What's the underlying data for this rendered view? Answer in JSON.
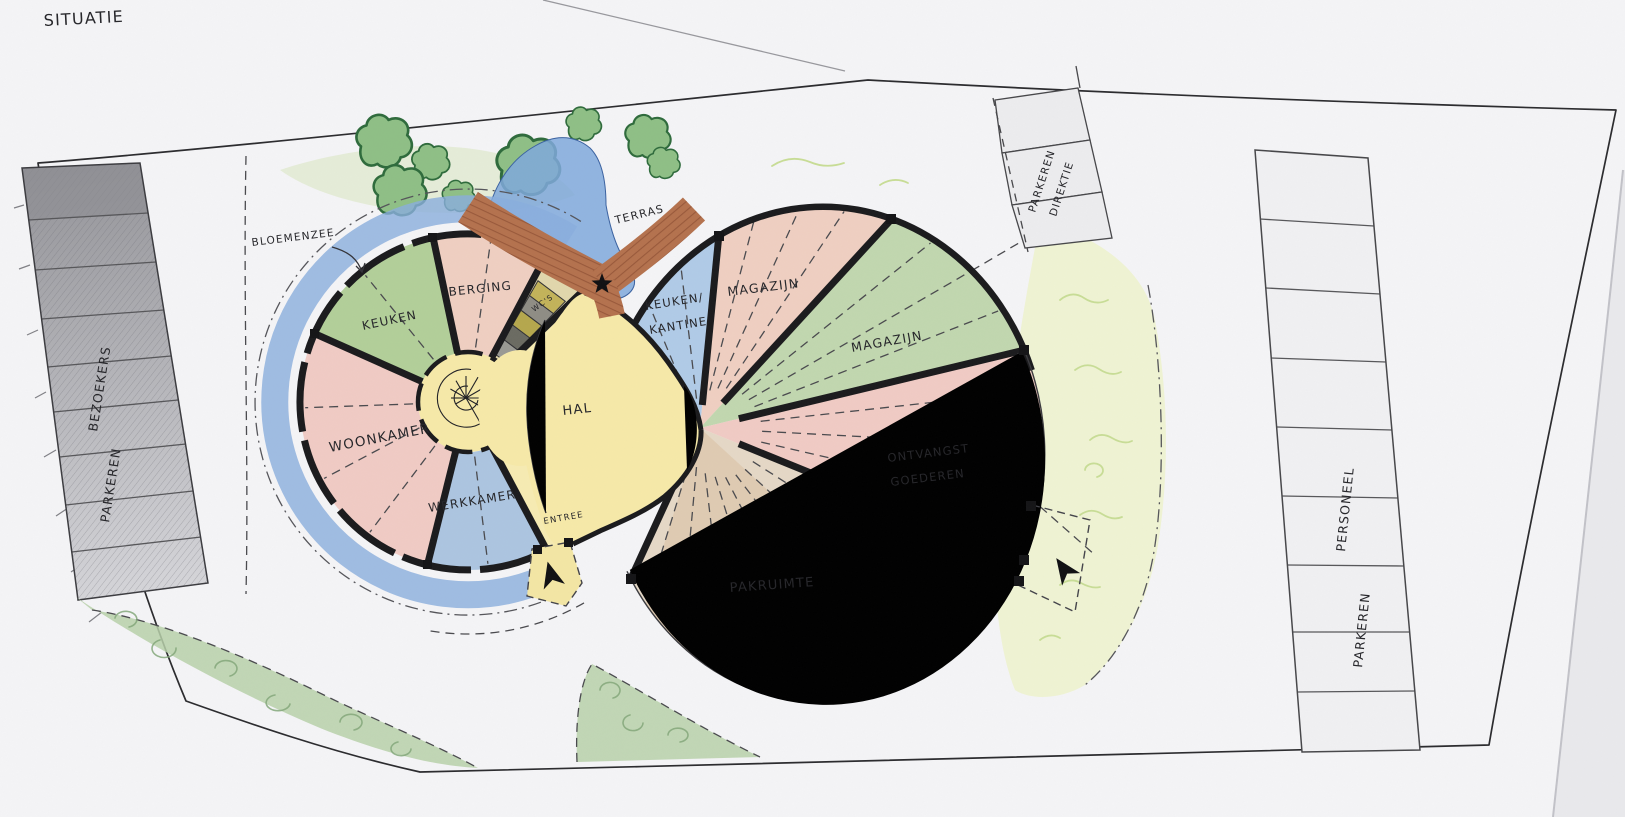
{
  "title": "SITUATIE",
  "colors": {
    "paper": "#f4f4f6",
    "wall": "#1b1b1d",
    "pink_room": "#efc5bd",
    "salmon_room": "#eec9ba",
    "green_room": "#a9c98c",
    "green_room_right": "#b9d3a5",
    "blue_room": "#a2bedd",
    "blue_room_right": "#a6c5e5",
    "yellow_hall": "#f6e9a8",
    "tan_pakruimte": "#e3d4bf",
    "brown_terrace": "#b4724e",
    "pond_blue": "#7fa8dc",
    "ring_blue": "#8aaedd",
    "tree_green": "#8fbf86",
    "area_green": "#b7d0a9",
    "grass_light": "#eff3d3",
    "parking_gray": "#ababaf",
    "wc_band": "#ded3a2"
  },
  "garden": {
    "bloemenzee": "BLOEMENZEE",
    "terras": "TERRAS"
  },
  "left_building": {
    "keuken": "KEUKEN",
    "berging": "BERGING",
    "wcs": "WC'S",
    "woonkamer": "WOONKAMER",
    "werkkamer": "WERKKAMER",
    "hal": "HAL",
    "entree": "ENTREE"
  },
  "right_building": {
    "keuken_kantine_1": "KEUKEN/",
    "keuken_kantine_2": "KANTINE",
    "magazijn_top": "MAGAZIJN",
    "magazijn_right": "MAGAZIJN",
    "ontvangst_1": "ONTVANGST",
    "ontvangst_2": "GOEDEREN",
    "pakruimte": "PAKRUIMTE"
  },
  "parking": {
    "bezoekers_1": "PARKEREN",
    "bezoekers_2": "BEZOEKERS",
    "direktie_1": "PARKEREN",
    "direktie_2": "DIREKTIE",
    "personeel_1": "PERSONEEL",
    "personeel_2": "PARKEREN"
  }
}
